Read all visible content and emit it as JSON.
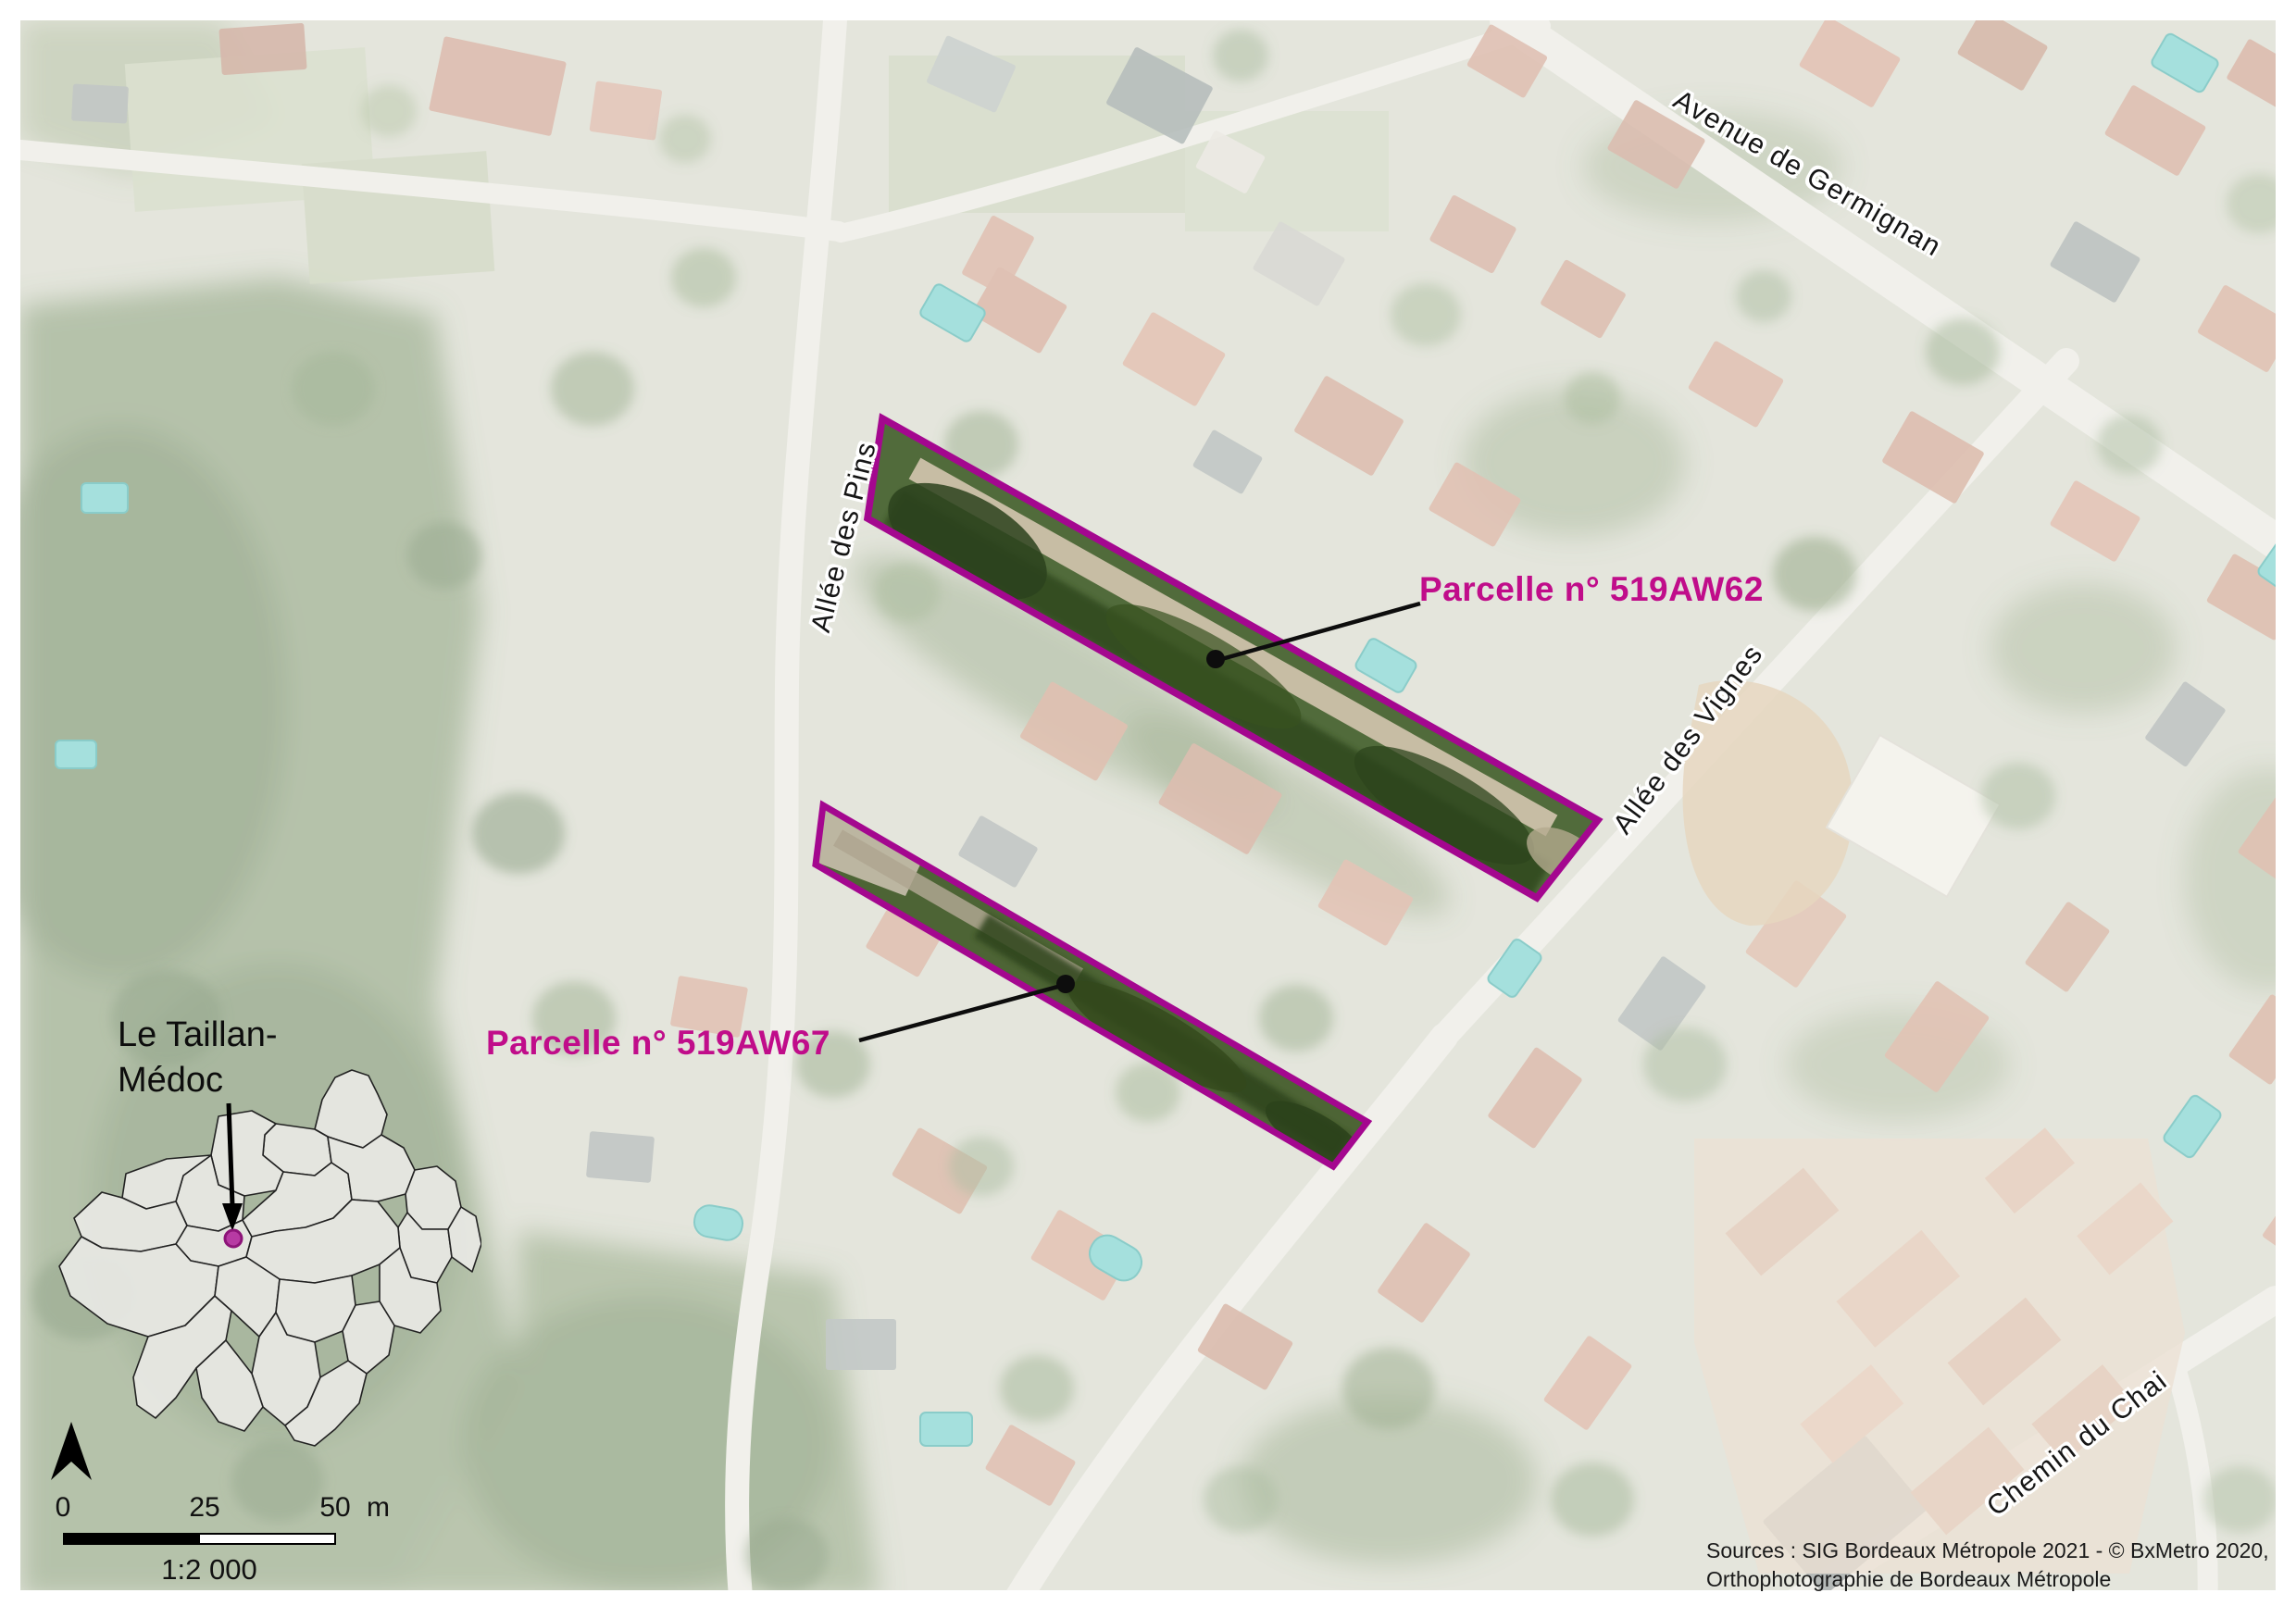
{
  "map": {
    "streets": {
      "germignan": "Avenue de Germignan",
      "pins": "Allée des Pins",
      "vignes": "Allée des Vignes",
      "chai": "Chemin du Chai"
    },
    "parcels": [
      {
        "id": "519AW62",
        "label": "Parcelle n° 519AW62"
      },
      {
        "id": "519AW67",
        "label": "Parcelle n° 519AW67"
      }
    ]
  },
  "inset": {
    "commune_line1": "Le Taillan-",
    "commune_line2": "Médoc"
  },
  "scalebar": {
    "tick0": "0",
    "tick1": "25",
    "tick2": "50",
    "unit": "m",
    "ratio": "1:2 000"
  },
  "credits": {
    "line1": "Sources : SIG Bordeaux Métropole 2021 - © BxMetro 2020,",
    "line2": "Orthophotographie de Bordeaux Métropole"
  },
  "colors": {
    "parcel_outline": "#a4078f",
    "parcel_label": "#c00d8a",
    "inset_marker": "#b73aa3",
    "leader": "#0d0d0d"
  }
}
